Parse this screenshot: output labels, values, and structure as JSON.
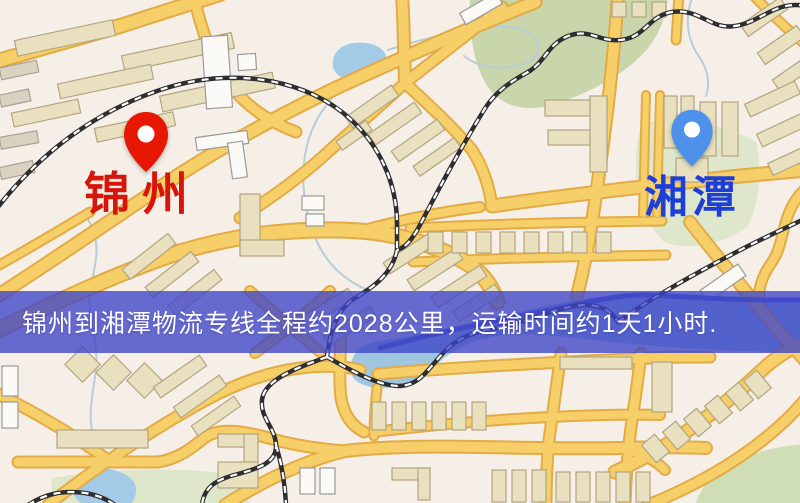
{
  "map": {
    "origin": {
      "name": "锦州"
    },
    "destination": {
      "name": "湘潭"
    }
  },
  "banner": {
    "text": "锦州到湘潭物流专线全程约2028公里，运输时间约1天1小时.",
    "distance_km": 2028,
    "transit_time": "1天1小时"
  },
  "colors": {
    "background": "#f6efe8",
    "origin_pin": "#e81703",
    "origin_label": "#d8150a",
    "destination_pin": "#4e91ea",
    "destination_label": "#1d3fd8",
    "banner_bg": "rgba(62,68,200,0.78)",
    "banner_text": "#ffffff",
    "road_fill": "#f6cf69",
    "road_casing": "#e2ab46",
    "water": "#9fc6e0",
    "water_channel": "#4553c4",
    "lake": "#a3cbe8",
    "park": "#ccd8ad",
    "railway": "#2e2e30",
    "building": "#e9e0bf"
  }
}
